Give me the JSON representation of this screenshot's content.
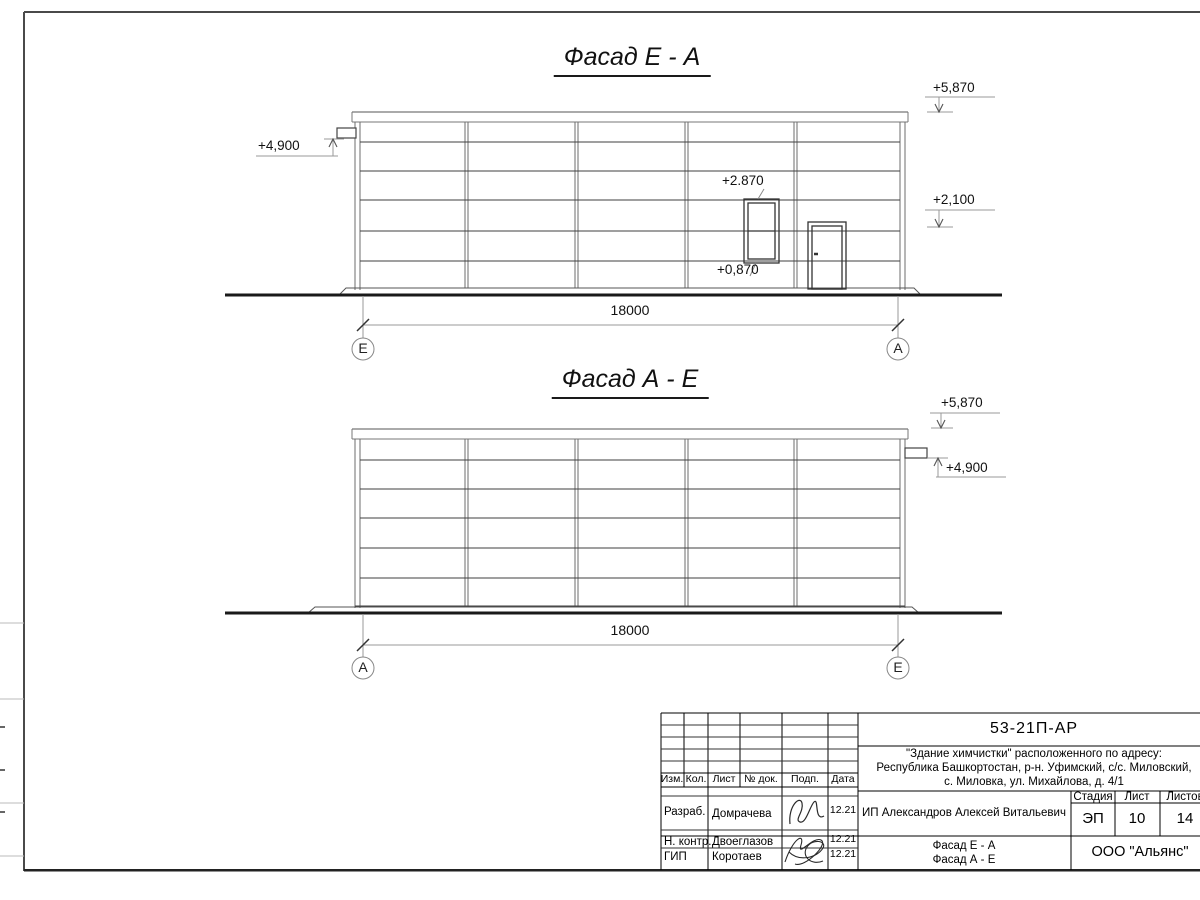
{
  "titles": {
    "facade_ea": "Фасад Е - А",
    "facade_ae": "Фасад А - Е"
  },
  "facade_ea": {
    "dim": "18000",
    "axis_left": "Е",
    "axis_right": "А",
    "elev_roof": "+5,870",
    "elev_canopy": "+4,900",
    "elev_mid": "+2,100",
    "window_top": "+2.870",
    "window_bottom": "+0,870"
  },
  "facade_ae": {
    "dim": "18000",
    "axis_left": "А",
    "axis_right": "Е",
    "elev_roof": "+5,870",
    "elev_pipe": "+4,900"
  },
  "titleblock": {
    "doc_code": "53-21П-АР",
    "address_line1": "\"Здание химчистки\" расположенного по адресу:",
    "address_line2": "Республика Башкортостан, р-н. Уфимский, с/с. Миловский,",
    "address_line3": "с. Миловка, ул. Михайлова, д. 4/1",
    "cols": {
      "izm": "Изм.",
      "kol": "Кол.",
      "list": "Лист",
      "doc": "№ док.",
      "podp": "Подп.",
      "date": "Дата"
    },
    "rows": [
      {
        "role": "Разраб.",
        "name": "Домрачева",
        "date": "12.21"
      },
      {
        "role": "Н. контр.",
        "name": "Двоеглазов",
        "date": "12.21"
      },
      {
        "role": "ГИП",
        "name": "Коротаев",
        "date": "12.21"
      }
    ],
    "client": "ИП Александров Алексей Витальевич",
    "stage_label": "Стадия",
    "sheet_label": "Лист",
    "sheets_label": "Листов",
    "stage": "ЭП",
    "sheet": "10",
    "sheets": "14",
    "content_line1": "Фасад Е - А",
    "content_line2": "Фасад А - Е",
    "company": "ООО \"Альянс\""
  }
}
